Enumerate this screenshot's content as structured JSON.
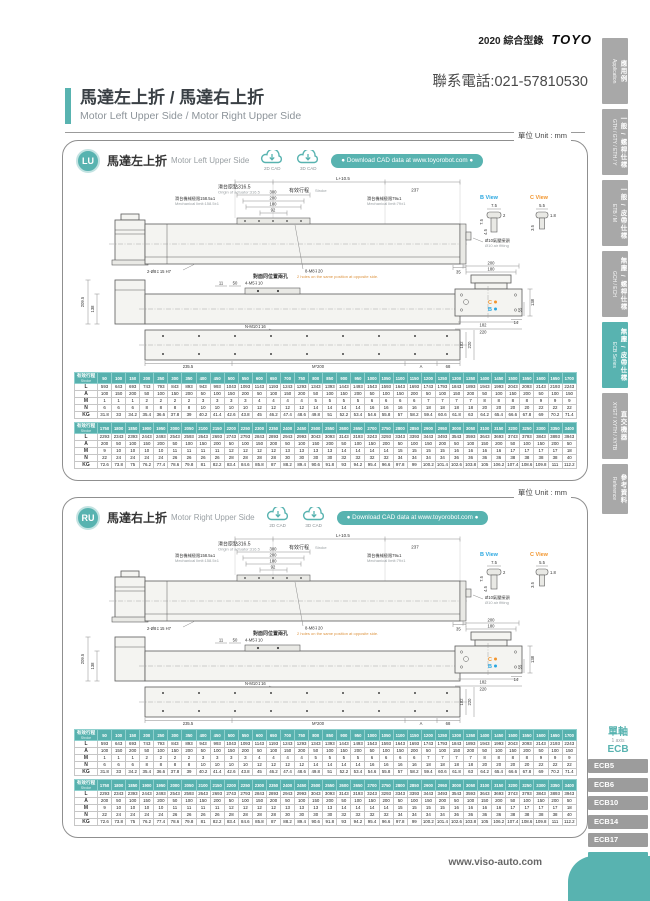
{
  "page": {
    "catalog_label": "2020 綜合型錄",
    "brand": "TOYO",
    "phone": "聯系電話:021-57810530",
    "unit_label": "單位 Unit : mm",
    "website": "www.viso-auto.com"
  },
  "title": {
    "zh": "馬達左上折 / 馬達右上折",
    "en": "Motor Left Upper Side / Motor Right Upper Side"
  },
  "sidebar": {
    "tabs": [
      {
        "zh": "應用例",
        "en": "Application"
      },
      {
        "zh": "一般 / 螺桿仕樣",
        "en": "GTH / GTY / ETH / Y"
      },
      {
        "zh": "一般 / 皮帶仕樣",
        "en": "ETB / M"
      },
      {
        "zh": "無塵 / 螺桿仕樣",
        "en": "GCH / ECH"
      },
      {
        "zh": "無塵 / 皮帶仕樣",
        "en": "ECB Series"
      },
      {
        "zh": "直交機器",
        "en": "XYGT / XYTH / XYTB"
      },
      {
        "zh": "參考資料",
        "en": "Reference"
      }
    ]
  },
  "sections": [
    {
      "badge": "LU",
      "zh": "馬達左上折",
      "en": "Motor Left Upper Side"
    },
    {
      "badge": "RU",
      "zh": "馬達右上折",
      "en": "Motor Right Upper Side"
    }
  ],
  "cad": {
    "icon_2d": "2D CAD",
    "icon_3d": "3D CAD",
    "download": "● Download CAD data at www.toyorobot.com ●"
  },
  "drawing": {
    "overall_len": "L+10.5",
    "origin_zh": "滑台原點316.5",
    "origin_en": "Origin of actuator:316.5",
    "stroke_zh": "有效行程",
    "stroke_en": "Stroke",
    "dim_237": "237",
    "mech_left_zh": "滑台機械極限158.5±1",
    "mech_left_en": "Mechanical limit:158.5±1",
    "mech_right_zh": "滑台機械極限79±1",
    "mech_right_en": "Mechanical limit:79±1",
    "dim_300": "300",
    "dim_200": "200",
    "dim_180": "180",
    "dim_92": "92",
    "hole_left": "2-Ø8↧15 H7",
    "hole_top": "8-M8↧20",
    "dim_35": "35",
    "opp_zh": "對面同位置兩孔",
    "opp_en": "2 holes on the same position at opposite side.",
    "dim_11": "11",
    "dim_50": "50",
    "hole_m5": "4-M5↧10",
    "dim_209_5": "209.5",
    "dim_138": "138",
    "hole_bottom": "N-M10↧16",
    "dim_235_5": "235.5",
    "dim_m200": "M*200",
    "dim_a": "A",
    "dim_68": "68",
    "dim_182": "182",
    "dim_220": "220",
    "air_zh": "Ø10氣壓接頭",
    "air_en": "Ø10 air fitting",
    "b_view": "B View",
    "c_view": "C View",
    "b_d1": "7.5",
    "b_d2": "2",
    "b_d3": "7.5",
    "b_d4": "4.5",
    "c_d1": "5.5",
    "c_d2": "1.8",
    "c_d3": "3.5",
    "ev_200": "200",
    "ev_180": "180",
    "ev_138": "138",
    "ev_55": "55",
    "ev_14": "14",
    "ev_182": "182",
    "ev_220": "220",
    "mk_b": "B",
    "mk_c": "C"
  },
  "tables": {
    "stroke_header_zh": "有效行程",
    "stroke_header_en": "Stroke",
    "t1": {
      "strokes": [
        50,
        100,
        150,
        200,
        250,
        300,
        350,
        400,
        450,
        500,
        550,
        600,
        650,
        700,
        750,
        800,
        850,
        900,
        950,
        1000,
        1050,
        1100,
        1150,
        1200,
        1250,
        1300,
        1350,
        1400,
        1450,
        1500,
        1550,
        1600,
        1650,
        1700
      ],
      "rows": [
        {
          "label": "L",
          "values": [
            593,
            643,
            693,
            743,
            793,
            843,
            893,
            943,
            993,
            1043,
            1093,
            1143,
            1193,
            1243,
            1293,
            1343,
            1393,
            1443,
            1493,
            1543,
            1593,
            1643,
            1693,
            1743,
            1793,
            1843,
            1893,
            1943,
            1993,
            2043,
            2093,
            2143,
            2193,
            2243
          ]
        },
        {
          "label": "A",
          "values": [
            100,
            150,
            200,
            50,
            100,
            150,
            200,
            50,
            100,
            150,
            200,
            50,
            100,
            150,
            200,
            50,
            100,
            150,
            200,
            50,
            100,
            150,
            200,
            50,
            100,
            150,
            200,
            50,
            100,
            150,
            200,
            50,
            100,
            150
          ]
        },
        {
          "label": "M",
          "values": [
            1,
            1,
            1,
            2,
            2,
            2,
            2,
            3,
            3,
            3,
            3,
            4,
            4,
            4,
            4,
            5,
            5,
            5,
            5,
            6,
            6,
            6,
            6,
            7,
            7,
            7,
            7,
            8,
            8,
            8,
            8,
            9,
            9,
            9
          ]
        },
        {
          "label": "N",
          "values": [
            6,
            6,
            6,
            8,
            8,
            8,
            8,
            10,
            10,
            10,
            10,
            12,
            12,
            12,
            12,
            14,
            14,
            14,
            14,
            16,
            16,
            16,
            16,
            18,
            18,
            18,
            18,
            20,
            20,
            20,
            20,
            22,
            22,
            22
          ]
        },
        {
          "label": "KG",
          "values": [
            31.8,
            33,
            34.2,
            35.4,
            36.6,
            37.8,
            39,
            40.2,
            41.4,
            42.6,
            43.8,
            45,
            46.2,
            47.4,
            48.6,
            49.8,
            51,
            52.2,
            53.4,
            54.6,
            55.8,
            57,
            58.2,
            59.4,
            60.6,
            61.8,
            63,
            64.2,
            65.4,
            66.6,
            67.8,
            69,
            70.2,
            71.4
          ]
        }
      ]
    },
    "t2": {
      "strokes": [
        1750,
        1800,
        1850,
        1900,
        1950,
        2000,
        2050,
        2100,
        2150,
        2200,
        2250,
        2300,
        2350,
        2400,
        2450,
        2500,
        2550,
        2600,
        2650,
        2700,
        2750,
        2800,
        2850,
        2900,
        2950,
        3000,
        3050,
        3100,
        3150,
        3200,
        3250,
        3300,
        3350,
        3400
      ],
      "rows": [
        {
          "label": "L",
          "values": [
            2293,
            2343,
            2393,
            2443,
            2493,
            2543,
            2593,
            2643,
            2693,
            2743,
            2793,
            2843,
            2893,
            2943,
            2993,
            3043,
            3093,
            3143,
            3193,
            3243,
            3293,
            3343,
            3393,
            3443,
            3493,
            3543,
            3593,
            3643,
            3693,
            3743,
            3793,
            3843,
            3893,
            3943
          ]
        },
        {
          "label": "A",
          "values": [
            200,
            50,
            100,
            150,
            200,
            50,
            100,
            150,
            200,
            50,
            100,
            150,
            200,
            50,
            100,
            150,
            200,
            50,
            100,
            150,
            200,
            50,
            100,
            150,
            200,
            50,
            100,
            150,
            200,
            50,
            100,
            150,
            200,
            50
          ]
        },
        {
          "label": "M",
          "values": [
            9,
            10,
            10,
            10,
            10,
            11,
            11,
            11,
            11,
            12,
            12,
            12,
            12,
            13,
            13,
            13,
            13,
            14,
            14,
            14,
            14,
            15,
            15,
            15,
            15,
            16,
            16,
            16,
            16,
            17,
            17,
            17,
            17,
            18
          ]
        },
        {
          "label": "N",
          "values": [
            22,
            24,
            24,
            24,
            24,
            26,
            26,
            26,
            26,
            28,
            28,
            28,
            28,
            30,
            30,
            30,
            30,
            32,
            32,
            32,
            32,
            34,
            34,
            34,
            34,
            36,
            36,
            36,
            36,
            38,
            38,
            38,
            38,
            40
          ]
        },
        {
          "label": "KG",
          "values": [
            72.6,
            73.8,
            75,
            76.2,
            77.4,
            78.6,
            79.8,
            81,
            82.2,
            83.4,
            84.6,
            85.8,
            87,
            88.2,
            89.4,
            90.6,
            91.8,
            93,
            94.2,
            95.4,
            96.6,
            97.8,
            99,
            100.2,
            101.4,
            102.6,
            103.8,
            105,
            106.2,
            107.4,
            108.6,
            109.8,
            111,
            112.2
          ]
        }
      ]
    }
  },
  "series_nav": {
    "group_zh": "單軸",
    "group_en": "1 axis",
    "group_code": "ECB",
    "items": [
      {
        "label": "ECB5"
      },
      {
        "label": "ECB6"
      },
      {
        "label": "ECB10"
      },
      {
        "label": "ECB14"
      },
      {
        "label": "ECB17"
      },
      {
        "label": "ECB22"
      }
    ]
  }
}
